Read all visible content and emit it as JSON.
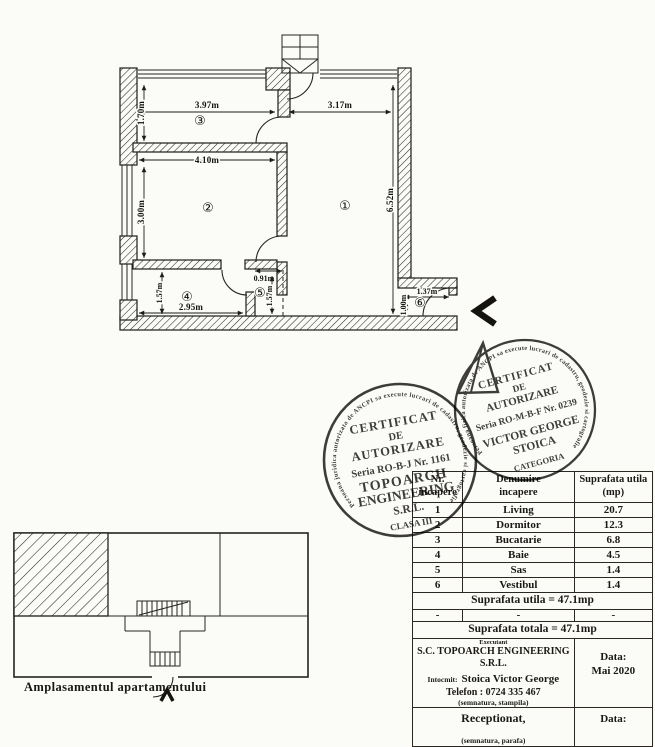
{
  "floor_plan": {
    "rooms": [
      {
        "symbol": "①",
        "name": "living"
      },
      {
        "symbol": "②",
        "name": "dormitor"
      },
      {
        "symbol": "③",
        "name": "bucatarie"
      },
      {
        "symbol": "④",
        "name": "baie"
      },
      {
        "symbol": "⑤",
        "name": "sas"
      },
      {
        "symbol": "⑥",
        "name": "vestibul"
      }
    ],
    "dims": {
      "kitchen_width": "3.97m",
      "living_width": "3.17m",
      "kitchen_depth": "1.70m",
      "bedroom_width": "4.10m",
      "bedroom_depth": "3.00m",
      "living_depth": "6.52m",
      "bath_depth": "1.57m",
      "bath_width": "2.95m",
      "sas_width": "0.91m",
      "sas_depth": "1.57m",
      "vestibule_width": "1.37m",
      "vestibule_depth": "1.00m"
    }
  },
  "stamps": {
    "company": {
      "ring": "Persoana juridica autorizata de ANCPI sa execute lucrari de cadastru, geodezie si cartografie",
      "title1": "CERTIFICAT",
      "title2": "DE",
      "title3": "AUTORIZARE",
      "serial": "Seria RO-B-J Nr. 1161",
      "name1": "TOPOARCH",
      "name2": "ENGINEERING",
      "name3": "S.R.L.",
      "class": "CLASA III"
    },
    "person": {
      "ring": "Persoana fizica autorizata de ANCPI sa execute lucrari de cadastru, geodezie si cartografie",
      "title1": "CERTIFICAT",
      "title2": "DE",
      "title3": "AUTORIZARE",
      "serial": "Seria RO-M-B-F Nr. 0239",
      "name1": "VICTOR GEORGE",
      "name2": "STOICA",
      "category": "CATEGORIA"
    }
  },
  "table": {
    "col1_header_line1": "Nr.",
    "col1_header_line2": "incapere",
    "col2_header_line1": "Denumire",
    "col2_header_line2": "incapere",
    "col3_header_line1": "Suprafata utila",
    "col3_header_line2": "(mp)",
    "rows": [
      {
        "nr": "1",
        "name": "Living",
        "area": "20.7"
      },
      {
        "nr": "2",
        "name": "Dormitor",
        "area": "12.3"
      },
      {
        "nr": "3",
        "name": "Bucatarie",
        "area": "6.8"
      },
      {
        "nr": "4",
        "name": "Baie",
        "area": "4.5"
      },
      {
        "nr": "5",
        "name": "Sas",
        "area": "1.4"
      },
      {
        "nr": "6",
        "name": "Vestibul",
        "area": "1.4"
      }
    ],
    "dash_row": [
      "-",
      "-",
      "-"
    ],
    "subtotal": "Suprafata utila = 47.1mp",
    "total": "Suprafata totala = 47.1mp",
    "executant_label": "Executant",
    "company": "S.C. TOPOARCH ENGINEERING S.R.L.",
    "intocmit_label": "Intocmit:",
    "intocmit_name": "Stoica Victor George",
    "phone": "Telefon : 0724 335 467",
    "sign_note": "(semnatura, stampila)",
    "date_label": "Data:",
    "date_value": "Mai 2020",
    "received_label": "Receptionat,",
    "received_date_label": "Data:",
    "received_note": "(semnatura, parafa)"
  },
  "site_plan": {
    "caption": "Amplasamentul apartamentului"
  }
}
